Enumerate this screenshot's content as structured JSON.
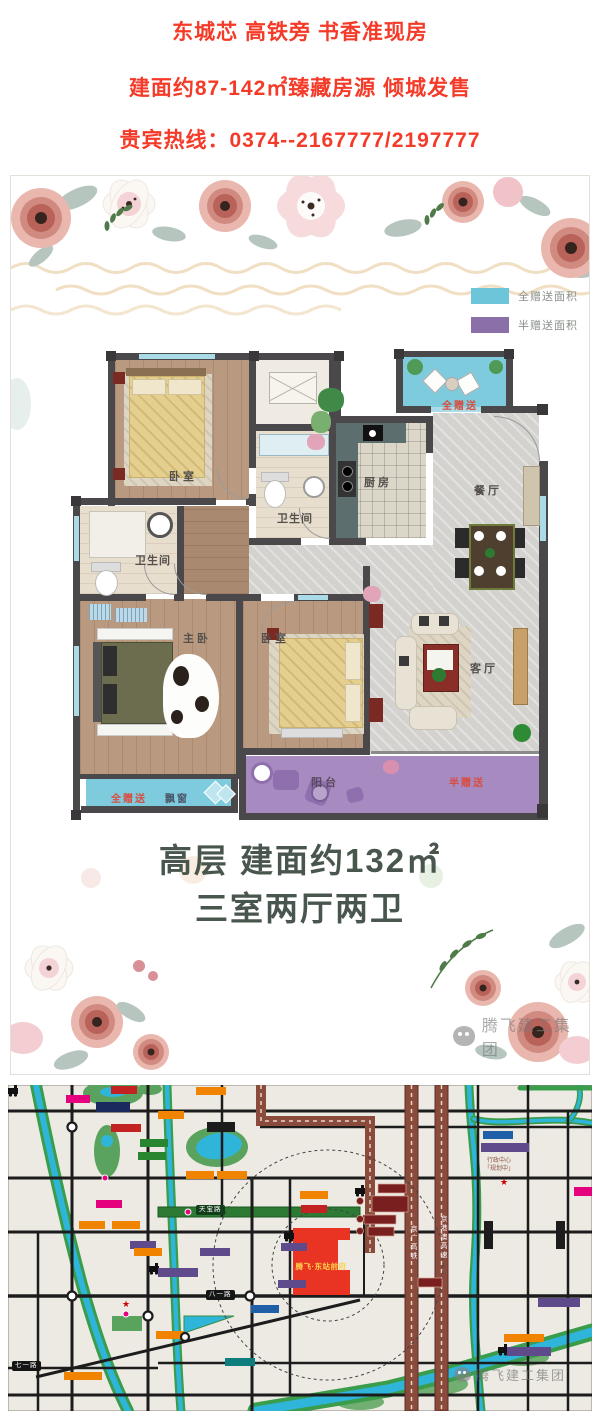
{
  "accent_colors": {
    "header_red": "#f43a28",
    "gift_full_cyan": "#6cc5d8",
    "gift_half_purple": "#8a6fa8",
    "project_red": "#e93323"
  },
  "header": {
    "line1": "东城芯 高铁旁 书香准现房",
    "line2": "建面约87-142㎡臻藏房源 倾城发售",
    "line3": "贵宾热线：0374--2167777/2197777"
  },
  "floorplan": {
    "legend": [
      {
        "label": "全赠送面积",
        "color": "#6cc5d8"
      },
      {
        "label": "半赠送面积",
        "color": "#8a6fa8"
      }
    ],
    "rooms": {
      "bedroom_top": "卧室",
      "bathroom_top": "卫生间",
      "bathroom_left": "卫生间",
      "kitchen": "厨房",
      "dining": "餐厅",
      "living": "客厅",
      "master_bedroom": "主卧",
      "bedroom_middle": "卧室",
      "balcony": "阳台"
    },
    "gift_labels": {
      "terrace_full": "全赠送",
      "bay_full": "全赠送",
      "bay_window": "飘窗",
      "balcony_half": "半赠送"
    },
    "caption_line1": "高层 建面约132㎡",
    "caption_line2": "三室两厅两卫",
    "watermark": "腾飞建工集团"
  },
  "map": {
    "project_label": "腾飞·东站前府",
    "railway_label": "京广高铁",
    "expressway_label": "京港澳高速",
    "roads": {
      "bayi": "八一路",
      "qiyi": "七一路",
      "tianbao": "天宝路"
    },
    "admin_center_line1": "行政中心",
    "admin_center_line2": "「规划中」",
    "watermark": "腾飞建工集团"
  }
}
